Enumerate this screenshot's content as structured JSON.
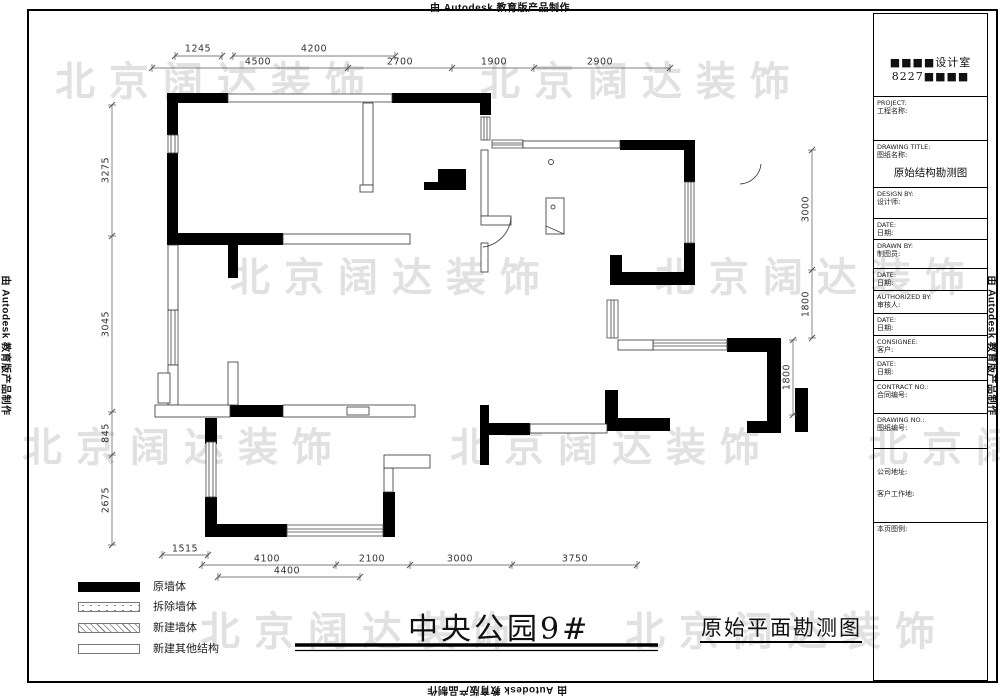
{
  "stamps": {
    "autodesk": "由 Autodesk 教育版产品制作"
  },
  "watermark": {
    "text": "北京阔达装饰",
    "color": "#e1e1e1"
  },
  "titles": {
    "project": "中央公园9#",
    "drawing": "原始平面勘测图"
  },
  "legend": {
    "items": [
      {
        "label": "原墙体",
        "style": "solid-black"
      },
      {
        "label": "拆除墙体",
        "style": "dotted"
      },
      {
        "label": "新建墙体",
        "style": "hatched"
      },
      {
        "label": "新建其他结构",
        "style": "empty"
      }
    ]
  },
  "dimensions": {
    "top": [
      "1245",
      "4200",
      "4500",
      "2700",
      "1900",
      "2900"
    ],
    "left": [
      "3275",
      "3045",
      "845",
      "2675"
    ],
    "right": [
      "3000",
      "1800",
      "1800"
    ],
    "bottom": [
      "1515",
      "4100",
      "4400",
      "2100",
      "3000",
      "3750"
    ]
  },
  "title_block": {
    "studio_line1": "■■■■设计室",
    "studio_line2": "8227■■■■",
    "drawing_title_value": "原始结构勘测图",
    "company_address_label": "公司地址:",
    "client_address_label": "客户工作地:",
    "page_legend_label": "本页图例:",
    "rows": [
      {
        "en": "PROJECT:",
        "zh": "工程名称:"
      },
      {
        "en": "DRAWING TITLE:",
        "zh": "图纸名称:"
      },
      {
        "en": "DESIGN BY:",
        "zh": "设计师:"
      },
      {
        "en": "DATE:",
        "zh": "日期:"
      },
      {
        "en": "DRAWN BY:",
        "zh": "制图员:"
      },
      {
        "en": "DATE:",
        "zh": "日期:"
      },
      {
        "en": "AUTHORIZED BY:",
        "zh": "审核人:"
      },
      {
        "en": "DATE:",
        "zh": "日期:"
      },
      {
        "en": "CONSIGNEE:",
        "zh": "客户:"
      },
      {
        "en": "DATE:",
        "zh": "日期:"
      },
      {
        "en": "CONTRACT NO.:",
        "zh": "合同编号:"
      },
      {
        "en": "DRAWING NO.:",
        "zh": "图纸编号:"
      }
    ]
  }
}
